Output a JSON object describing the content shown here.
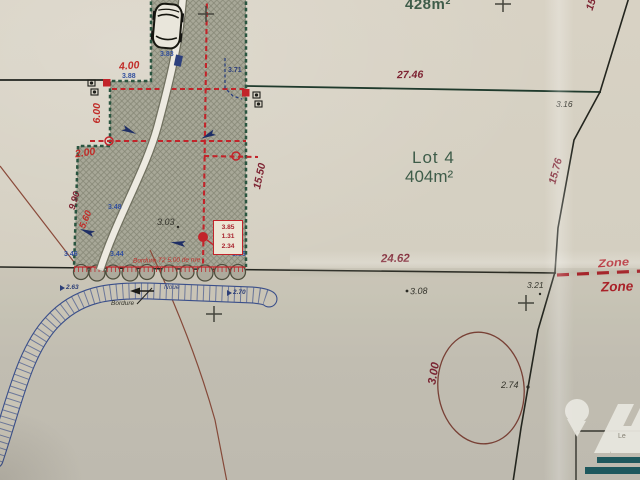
{
  "plan": {
    "parcels": {
      "top_area": "428m²",
      "lot4": {
        "name": "Lot 4",
        "area": "404m²"
      }
    },
    "boundary_dims": {
      "d27_46": "27.46",
      "d24_62": "24.62",
      "d15_76": "15.76",
      "d15_50": "15.50",
      "d4_00": "4.00",
      "d6_00": "6.00",
      "d2_00": "2.00",
      "d9_90": "9.90",
      "d5_60": "5.60",
      "top_right_partial": "15."
    },
    "spot_levels": {
      "p3_16": "3.16",
      "p3_83": "3.83",
      "p3_88": "3.88",
      "p3_71": "3.71",
      "p3_48": "3.48",
      "p3_03": "3.03",
      "p3_46": "3.46",
      "p3_44": "3.44",
      "p3_86": "3.86",
      "p3_08": "3.08",
      "p3_21": "3.21",
      "p2_74": "2.74",
      "p2_63": "2.63",
      "p2_70": "2.70",
      "p3_00": "3.00"
    },
    "refbox": {
      "v1": "3.85",
      "v2": "1.31",
      "v3": "2.34"
    },
    "zone": {
      "upper": "Zone",
      "lower": "Zone"
    },
    "notes": {
      "bordure_red": "Bordure T2 5.00 de rue",
      "bordure_black": "Bordure",
      "noue": "Noue"
    },
    "watermark": {
      "partial_text": "Le"
    },
    "colors": {
      "paper": "#d4cec0",
      "parcel_hatch": "#a8a898",
      "boundary_green": "#2a5540",
      "dim_red": "#c12c28",
      "dim_maroon": "#7e2433",
      "note_blue": "#33509e",
      "zone_red": "#b01f28",
      "teal_bar": "#1c5a60"
    }
  }
}
